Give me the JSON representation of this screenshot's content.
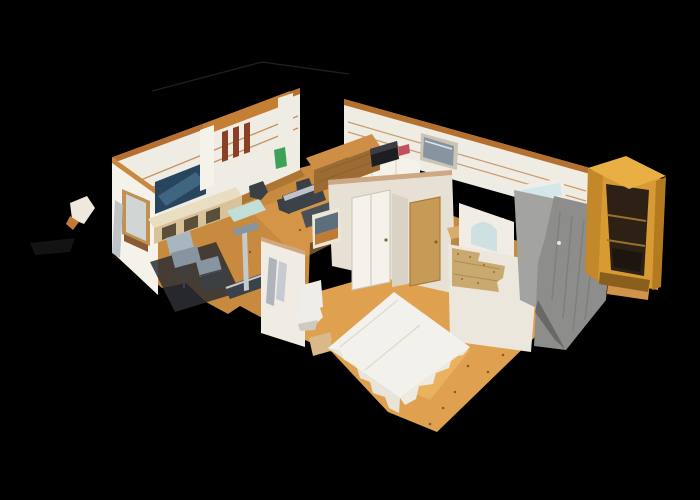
{
  "meta": {
    "view_label": "3D dollhouse cutaway view of an apartment scan",
    "background": "#000000"
  },
  "scene": {
    "style": "matterport-dollhouse",
    "rooms": [
      {
        "name": "living-room",
        "contents": [
          "wall-mounted-tv",
          "media-console",
          "window",
          "curtain",
          "office-chairs",
          "treadmill",
          "dining-chairs"
        ]
      },
      {
        "name": "kitchen",
        "contents": [
          "wood-hutch",
          "black-printer",
          "red-item",
          "green-bottle",
          "dark-counters"
        ]
      },
      {
        "name": "hallway",
        "contents": [
          "white-door",
          "wood-door",
          "picture-frame"
        ]
      },
      {
        "name": "bathroom",
        "contents": [
          "toilet",
          "hanging-towels",
          "bath-mat"
        ]
      },
      {
        "name": "corridor",
        "contents": [
          "arched-doorway",
          "wood-dresser",
          "bathtub-rim",
          "blue-toiletries"
        ]
      },
      {
        "name": "bedroom",
        "contents": [
          "draped-white-bed",
          "plywood-patch-wall",
          "wood-floor"
        ]
      },
      {
        "name": "shower-room",
        "contents": [
          "gray-tile-wall",
          "hanging-towel"
        ]
      },
      {
        "name": "closet-nook",
        "contents": [
          "orange-open-wardrobe",
          "bench"
        ]
      }
    ],
    "floating_debris": [
      "small-scan-fragment-left"
    ]
  },
  "palette": {
    "bg": "#000000",
    "ceil_line": "#242424",
    "smudge": "#131313",
    "wall_main": "#efece3",
    "wall_bright": "#f5f2ea",
    "wall_shade": "#e7e1d5",
    "wall_dim": "#d9d2c5",
    "wall_lower": "#ece7dc",
    "wood_trim": "#b5702f",
    "wood_trim_light": "#c98742",
    "floor_main": "#c88a3e",
    "floor_bright": "#dfa050",
    "floor_glow": "#f2c06a",
    "floor_shadow": "#5a3a18",
    "floor_dot": "#7a4a1f",
    "tv_screen": "#28455e",
    "tv_glow": "#4a7390",
    "console_top": "#e9ddc2",
    "console_front": "#d8c29a",
    "console_cubby": "#5b4f3a",
    "window_frame": "#c09055",
    "window_glass": "#cfd6d4",
    "window_sill": "#8a5a33",
    "curtain": "#b9bfc4",
    "chair_light": "#a8b6c0",
    "chair_mid": "#8795a1",
    "chair_dark": "#3b4047",
    "floor_mat": "#2e2f33",
    "deck_dark": "#3c424a",
    "pole_light": "#c6c9cd",
    "desk_aqua": "#c2ded8",
    "loft_beam": "#c47f35",
    "loft_slat": "#8a4024",
    "hutch_top": "#cf8e45",
    "hutch_front": "#9c6a33",
    "printer_body": "#1e1e22",
    "printer_top": "#3c3c44",
    "red_item": "#c2505e",
    "green_item": "#3da257",
    "counter_dark": "#3c424a",
    "counter_dark2": "#4a5058",
    "counter_glint": "#dfe4e8",
    "door_white": "#f5f2eb",
    "door_frame": "#cbc4b6",
    "door_wood": "#c79a55",
    "door_wood_edge": "#a87c3a",
    "pic_frame": "#ece6d8",
    "pic_sky": "#5d6e7c",
    "pic_field": "#c07c35",
    "bath_wall": "#f0ece3",
    "towel_a": "#aeb4ba",
    "towel_b": "#c6cbd0",
    "toilet_white": "#efede7",
    "toilet_shade": "#cfcabf",
    "bath_mat": "#d9b98a",
    "plywood": "#c9a96f",
    "plywood_line": "#a98550",
    "screw_dot": "#7c5c34",
    "bed_white": "#f3f1ec",
    "bed_drape": "#e9e4da",
    "bed_drape2": "#eeeae1",
    "bed_shade": "#d8d2c6",
    "arch_wall": "#f1ede4",
    "arch_inner": "#cfe0e2",
    "dresser_top": "#d9ad69",
    "dresser_front": "#b98948",
    "drawer_line": "#8a6230",
    "tub_rim": "#f0ede6",
    "tub_inner": "#d4e7ea",
    "toiletry_blue": "#3a5fc0",
    "toiletry_blue2": "#5b7fd4",
    "shower_inner": "#a3a3a1",
    "shower_towel": "#e9e7e1",
    "tile_gray": "#8d8d8b",
    "tile_line": "#717170",
    "tile_dark": "#5f5f5d",
    "wood_side_strip": "#d1924a",
    "bench_dark": "#2e2a24",
    "ward_top": "#e9ae44",
    "ward_face": "#d89a32",
    "ward_side": "#b37a20",
    "ward_col": "#c2882a",
    "ward_interior": "#2c2114",
    "ward_shelf": "#9a702f",
    "ward_clothes": "#1c1510",
    "ward_slats": "#8a5f1d",
    "frag_white": "#efe9dd",
    "frag_orange": "#c07a33"
  }
}
